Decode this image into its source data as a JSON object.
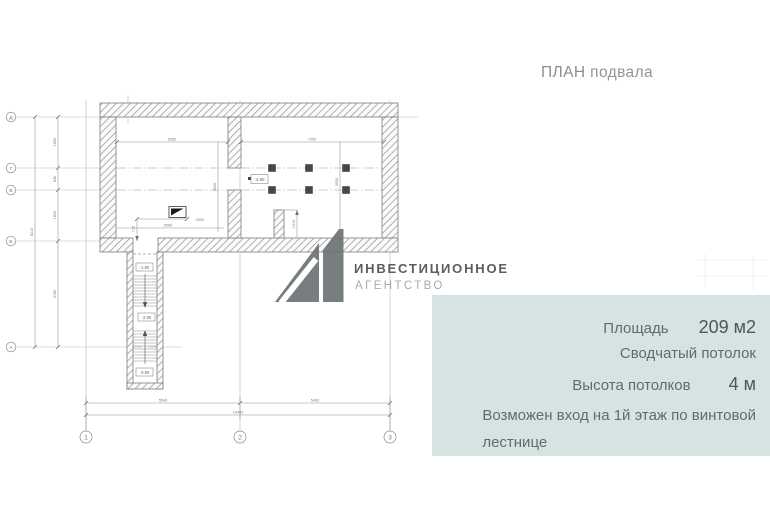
{
  "page": {
    "title_word1": "ПЛАН",
    "title_word2": "подвала"
  },
  "logo": {
    "line1": "ИНВЕСТИЦИОННОЕ",
    "line2": "АГЕНТСТВО",
    "mark_color": "#6e7376"
  },
  "info_panel": {
    "bg_color": "#d5e3e3",
    "area_label": "Площадь",
    "area_value": "209 м2",
    "ceiling_type": "Сводчатый потолок",
    "height_label": "Высота потолков",
    "height_value": "4 м",
    "entrance_note_line1": "Возможен вход на 1й этаж по винтовой",
    "entrance_note_line2": "лестнице"
  },
  "plan": {
    "axis_bottom": [
      "1",
      "2",
      "3"
    ],
    "axis_left": [
      "Д",
      "Г",
      "В",
      "Б",
      "А"
    ],
    "dim_room_left_w": "5280",
    "dim_room_right_w": "7050",
    "dim_room_left_h": "3030",
    "dim_room_right_h": "3030",
    "dim_bottom_seg1": "5540",
    "dim_bottom_seg2": "5400",
    "dim_bottom_total": "10940",
    "dim_left_seg1": "1800",
    "dim_left_seg2": "830",
    "dim_left_seg3": "1800",
    "dim_left_seg4": "3780",
    "dim_left_total": "8210",
    "dim_sym1": "2420",
    "dim_sym2": "5080",
    "dim_sym_v": "710",
    "dim_stub": "1010",
    "stair_levels": [
      "-1.80",
      "-2.80",
      "-3.80"
    ],
    "room_level": "-4.50"
  }
}
